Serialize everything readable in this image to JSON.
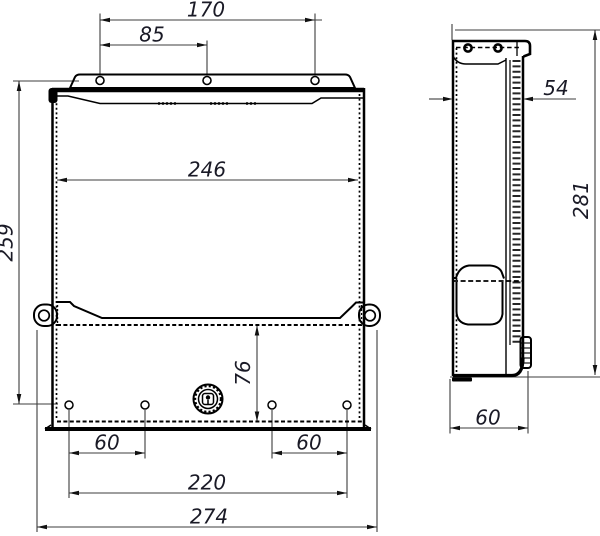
{
  "drawing": {
    "kind": "technical-drawing-two-views",
    "background": "#ffffff",
    "outline_color": "#000000",
    "dimension_line_color": "#3d3d3d",
    "dimension_text_color": "#1a1a26",
    "views": [
      {
        "id": "front",
        "label": "front-view"
      },
      {
        "id": "side",
        "label": "side-view"
      }
    ],
    "dimensions": {
      "top_hole_span_full": "170",
      "top_hole_span_half": "85",
      "body_inner_width": "246",
      "body_height": "259",
      "lower_section_height": "76",
      "bottom_hole_spacing_left": "60",
      "bottom_hole_spacing_right": "60",
      "bottom_hole_span": "220",
      "overall_width": "274",
      "side_top_depth": "54",
      "side_overall_height": "281",
      "side_bottom_depth": "60"
    }
  }
}
